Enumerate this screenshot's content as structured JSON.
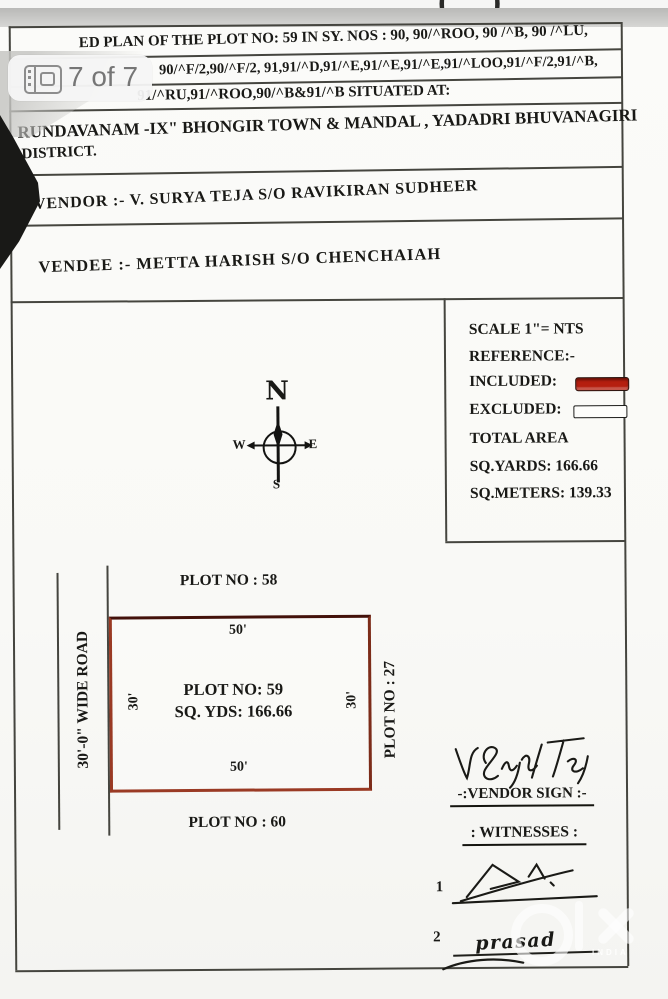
{
  "viewer": {
    "page_indicator": "7 of 7",
    "top_mark": "( )",
    "watermark": {
      "brand": "olx",
      "sub": "INDIA"
    }
  },
  "document": {
    "header_lines": [
      "ED PLAN OF THE PLOT NO: 59 IN SY. NOS : 90, 90/^ROO, 90 /^B, 90 /^LU,",
      "90/^F/2,90/^F/2, 91,91/^D,91/^E,91/^E,91/^E,91/^LOO,91/^F/2,91/^B,",
      "91/^RU,91/^ROO,90/^B&91/^B SITUATED AT:",
      "RUNDAVANAM -IX\" BHONGIR TOWN &  MANDAL , YADADRI BHUVANAGIRI",
      "DISTRICT."
    ],
    "vendor": "VENDOR :-   V. SURYA TEJA   S/O RAVIKIRAN SUDHEER",
    "vendee": "VENDEE :-   METTA HARISH   S/O CHENCHAIAH",
    "legend": {
      "scale": "SCALE 1\"= NTS",
      "reference": "REFERENCE:-",
      "included": "INCLUDED:",
      "excluded": "EXCLUDED:",
      "total_area": "TOTAL AREA",
      "sq_yards": "SQ.YARDS: 166.66",
      "sq_meters": "SQ.METERS: 139.33",
      "included_color": "#b51e0f",
      "excluded_color": "#fdfdfb"
    },
    "compass": {
      "n": "N",
      "e": "E",
      "s": "S",
      "w": "W"
    },
    "plot": {
      "north_label": "PLOT NO : 58",
      "south_label": "PLOT NO : 60",
      "east_label": "PLOT NO : 27",
      "west_label": "30'-0\" WIDE ROAD",
      "top_dim": "50'",
      "bottom_dim": "50'",
      "left_dim": "30'",
      "right_dim": "30'",
      "center_line1": "PLOT NO: 59",
      "center_line2": "SQ. YDS: 166.66",
      "outline_color": "#9a3a24"
    },
    "signatures": {
      "vendor_sign_label": "-:VENDOR SIGN :-",
      "witnesses_label": ": WITNESSES :",
      "witness1_no": "1",
      "witness2_no": "2",
      "witness2_name": "prasad"
    }
  }
}
